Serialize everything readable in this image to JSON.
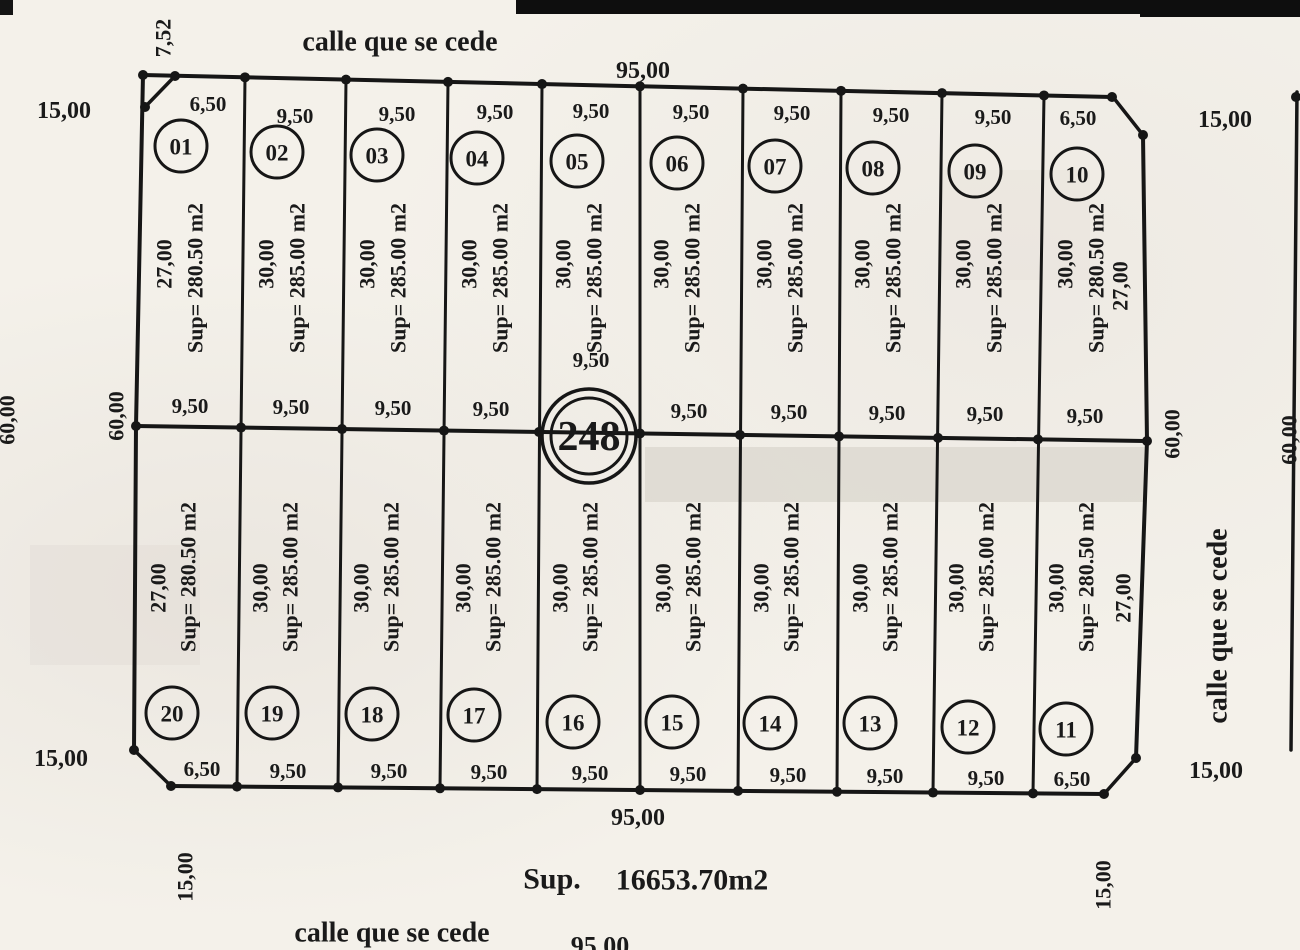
{
  "streets": {
    "top": "calle que se cede",
    "right": "calle que se cede",
    "bottom": "calle que se cede"
  },
  "dims": {
    "total_top": "95,00",
    "total_bottom": "95,00",
    "total_bottom_street": "95,00",
    "chamfer": "7,52",
    "corner_tl": "15,00",
    "corner_tr": "15,00",
    "corner_bl": "15,00",
    "corner_br": "15,00",
    "street_bl_v": "15,00",
    "street_br_v": "15,00",
    "left_outer": "60,00",
    "left_inner": "60,00",
    "right_inner": "60,00",
    "right_outer": "60,00"
  },
  "block": {
    "number": "248"
  },
  "total_area": {
    "label": "Sup.",
    "value": "16653.70m2"
  },
  "lots_top": [
    {
      "number": "01",
      "top_width": "6,50",
      "depth": "27,00",
      "area": "Sup= 280.50 m2",
      "mid_width": "9,50"
    },
    {
      "number": "02",
      "top_width": "9,50",
      "depth": "30,00",
      "area": "Sup= 285.00 m2",
      "mid_width": "9,50"
    },
    {
      "number": "03",
      "top_width": "9,50",
      "depth": "30,00",
      "area": "Sup= 285.00 m2",
      "mid_width": "9,50"
    },
    {
      "number": "04",
      "top_width": "9,50",
      "depth": "30,00",
      "area": "Sup= 285.00 m2",
      "mid_width": "9,50"
    },
    {
      "number": "05",
      "top_width": "9,50",
      "depth": "30,00",
      "area": "Sup= 285.00 m2",
      "mid_width": "9,50"
    },
    {
      "number": "06",
      "top_width": "9,50",
      "depth": "30,00",
      "area": "Sup= 285.00 m2",
      "mid_width": "9,50"
    },
    {
      "number": "07",
      "top_width": "9,50",
      "depth": "30,00",
      "area": "Sup= 285.00 m2",
      "mid_width": "9,50"
    },
    {
      "number": "08",
      "top_width": "9,50",
      "depth": "30,00",
      "area": "Sup= 285.00 m2",
      "mid_width": "9,50"
    },
    {
      "number": "09",
      "top_width": "9,50",
      "depth": "30,00",
      "area": "Sup= 285.00 m2",
      "mid_width": "9,50"
    },
    {
      "number": "10",
      "top_width": "6,50",
      "depth": "30,00",
      "area": "Sup= 280.50 m2",
      "side": "27,00",
      "mid_width": "9,50"
    }
  ],
  "lots_bottom": [
    {
      "number": "20",
      "bottom_width": "6,50",
      "depth": "27,00",
      "area": "Sup= 280.50 m2"
    },
    {
      "number": "19",
      "bottom_width": "9,50",
      "depth": "30,00",
      "area": "Sup= 285.00 m2"
    },
    {
      "number": "18",
      "bottom_width": "9,50",
      "depth": "30,00",
      "area": "Sup= 285.00 m2"
    },
    {
      "number": "17",
      "bottom_width": "9,50",
      "depth": "30,00",
      "area": "Sup= 285.00 m2"
    },
    {
      "number": "16",
      "bottom_width": "9,50",
      "depth": "30,00",
      "area": "Sup= 285.00 m2"
    },
    {
      "number": "15",
      "bottom_width": "9,50",
      "depth": "30,00",
      "area": "Sup= 285.00 m2"
    },
    {
      "number": "14",
      "bottom_width": "9,50",
      "depth": "30,00",
      "area": "Sup= 285.00 m2"
    },
    {
      "number": "13",
      "bottom_width": "9,50",
      "depth": "30,00",
      "area": "Sup= 285.00 m2"
    },
    {
      "number": "12",
      "bottom_width": "9,50",
      "depth": "30,00",
      "area": "Sup= 285.00 m2"
    },
    {
      "number": "11",
      "bottom_width": "6,50",
      "depth": "30,00",
      "area": "Sup= 280.50 m2",
      "side": "27,00"
    }
  ]
}
